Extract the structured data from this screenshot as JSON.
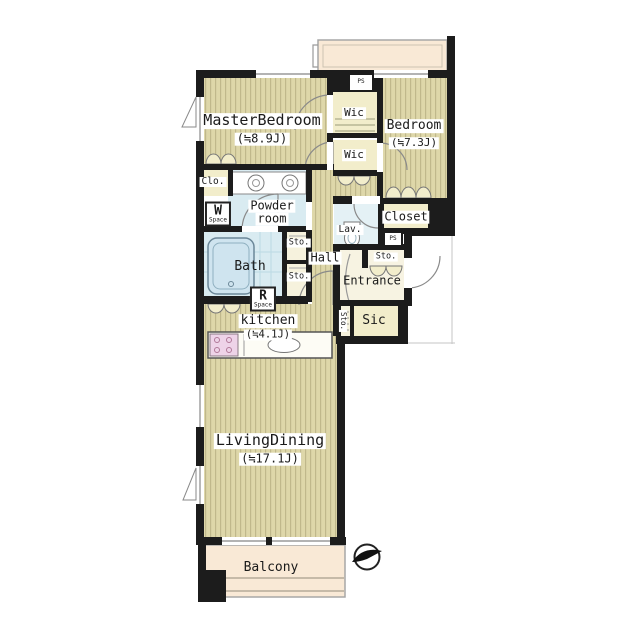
{
  "plan_type": "apartment-floor-plan",
  "labels": {
    "master_bedroom_name": "MasterBedroom",
    "master_bedroom_area": "(≒8.9J)",
    "bedroom_name": "Bedroom",
    "bedroom_area": "(≒7.3J)",
    "living_dining_name": "LivingDining",
    "living_dining_area": "(≒17.1J)",
    "kitchen_name": "kitchen",
    "kitchen_area": "(≒4.1J)",
    "wic_top": "Wic",
    "wic_bottom": "Wic",
    "closet": "Closet",
    "clo": "Clo.",
    "powder_line1": "Powder",
    "powder_line2": "room",
    "bath": "Bath",
    "lav": "Lav.",
    "hall": "Hall",
    "entrance": "Entrance",
    "sic": "Sic",
    "balcony": "Balcony",
    "sto_1": "Sto.",
    "sto_2": "Sto.",
    "sto_3": "Sto.",
    "sto_4": "Sto.",
    "w_space_main": "W",
    "w_space_sub": "Space",
    "r_space_main": "R",
    "r_space_sub": "Space",
    "ps_1": "PS",
    "ps_2": "PS"
  },
  "colors": {
    "wall": "#1c1c1c",
    "floor_wood": "#ded7a9",
    "floor_stripe": "#a89f72",
    "room_cream": "#f2edcb",
    "wet_area_blue": "#d9ebf1",
    "balcony_peach": "#f9e9d6",
    "stove_pink": "#eed3e8",
    "line_gray": "#9a9a9a"
  },
  "compass": {
    "icon": "north-arrow",
    "points": "right"
  }
}
